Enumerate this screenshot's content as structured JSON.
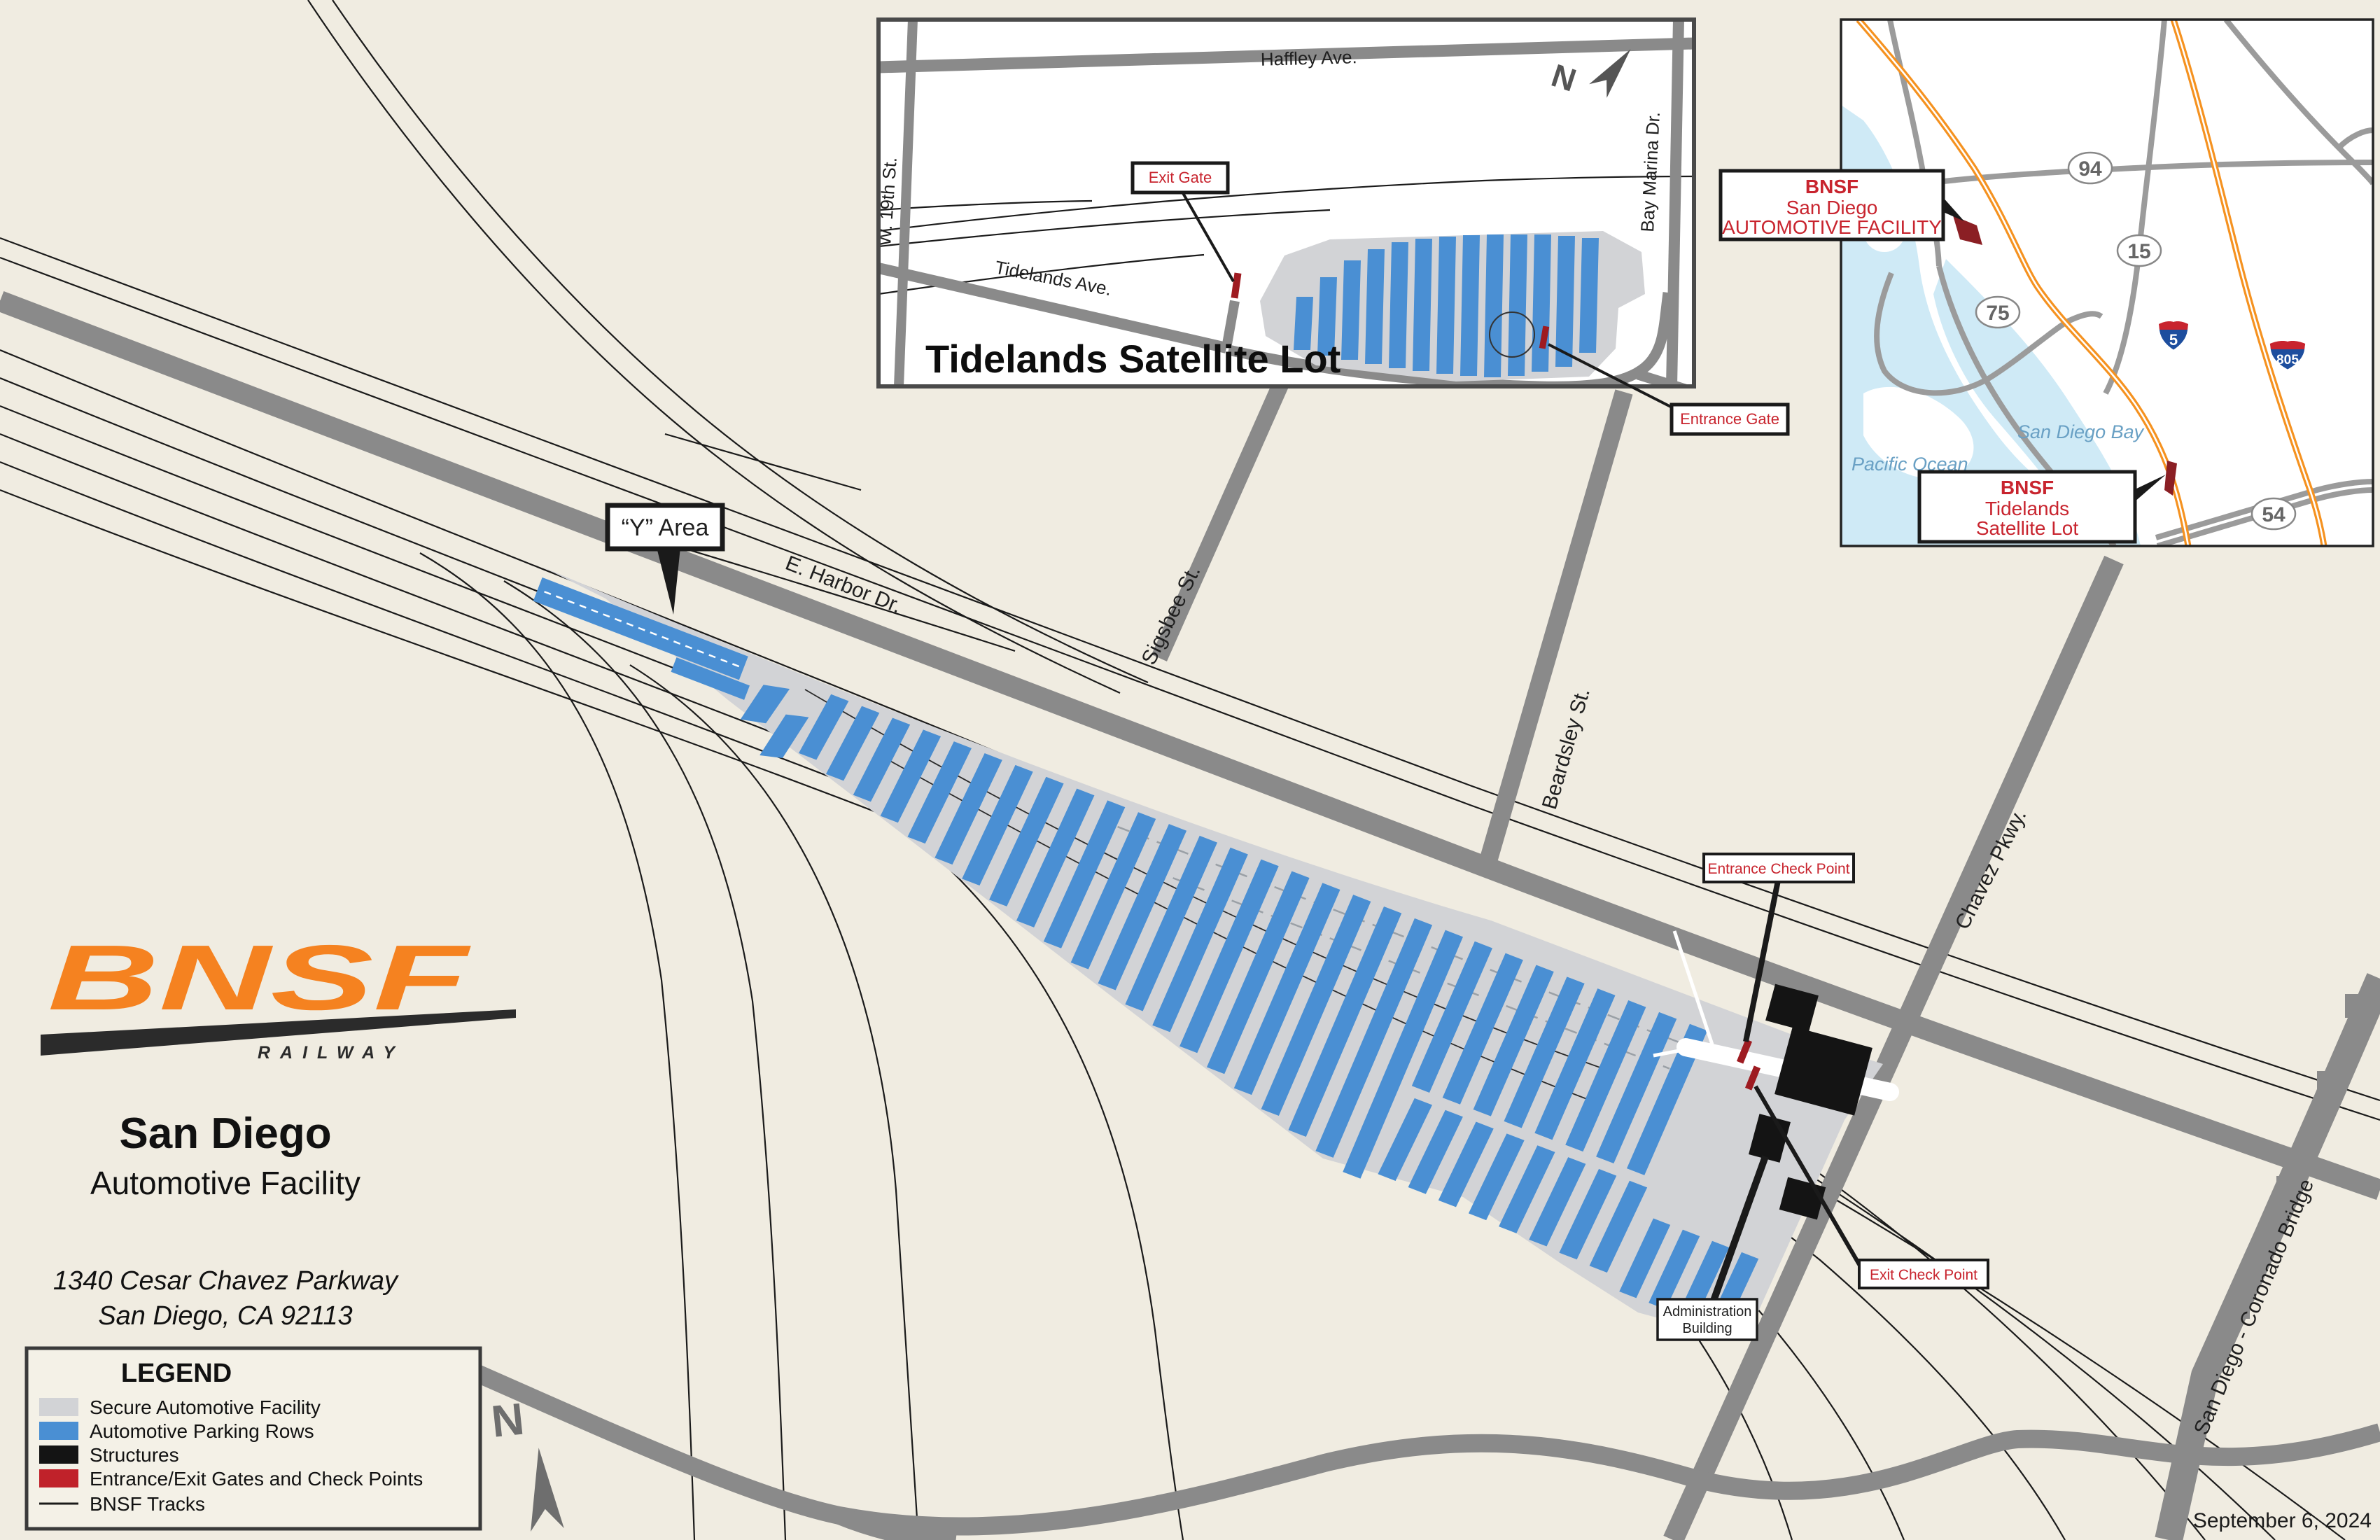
{
  "colors": {
    "background": "#f0ece1",
    "road_gray": "#8a8a8a",
    "secure_facility": "#d2d3d6",
    "parking_rows": "#4a8fd3",
    "structures": "#141414",
    "gates_checkpoints": "#c0222a",
    "gate_marker_dark": "#9e1b21",
    "bnsf_tracks": "#1a1a1a",
    "water": "#cfeaf6",
    "freeway_orange": "#f59220",
    "label_red": "#c8242e",
    "logo_orange": "#f58220"
  },
  "logo": {
    "name": "BNSF",
    "railway": "RAILWAY"
  },
  "title": {
    "city": "San Diego",
    "facility": "Automotive Facility",
    "address_line1": "1340 Cesar Chavez Parkway",
    "address_line2": "San Diego, CA 92113"
  },
  "date": "September 6, 2024",
  "legend": {
    "title": "LEGEND",
    "items": [
      {
        "label": "Secure Automotive Facility"
      },
      {
        "label": "Automotive Parking Rows"
      },
      {
        "label": "Structures"
      },
      {
        "label": "Entrance/Exit Gates and Check Points"
      },
      {
        "label": "BNSF Tracks"
      }
    ]
  },
  "main_map": {
    "north_letter": "N",
    "streets": {
      "harbor": "E. Harbor Dr.",
      "sigsbee": "Sigsbee St.",
      "beardsley": "Beardsley St.",
      "chavez": "Chavez Pkwy.",
      "coronado": "San Diego - Coronado Bridge"
    },
    "callouts": {
      "y_area": "“Y” Area",
      "entrance_check": "Entrance Check Point",
      "exit_check": "Exit Check Point",
      "admin_line1": "Administration",
      "admin_line2": "Building"
    }
  },
  "tidelands_inset": {
    "title": "Tidelands Satellite Lot",
    "north_letter": "N",
    "streets": {
      "haffley": "Haffley Ave.",
      "w19th": "W. 19th St.",
      "bay_marina": "Bay Marina Dr.",
      "tidelands": "Tidelands Ave."
    },
    "callouts": {
      "exit_gate": "Exit Gate",
      "entrance_gate": "Entrance Gate"
    }
  },
  "regional_inset": {
    "water_labels": {
      "ocean": "Pacific Ocean",
      "bay": "San Diego Bay"
    },
    "route_shields": {
      "r94": "94",
      "r15": "15",
      "r75": "75",
      "r54": "54",
      "i5": "5",
      "i805": "805"
    },
    "callouts": {
      "facility": {
        "line1": "BNSF",
        "line2": "San Diego",
        "line3": "AUTOMOTIVE FACILITY"
      },
      "tidelands": {
        "line1": "BNSF",
        "line2": "Tidelands",
        "line3": "Satellite Lot"
      }
    }
  }
}
